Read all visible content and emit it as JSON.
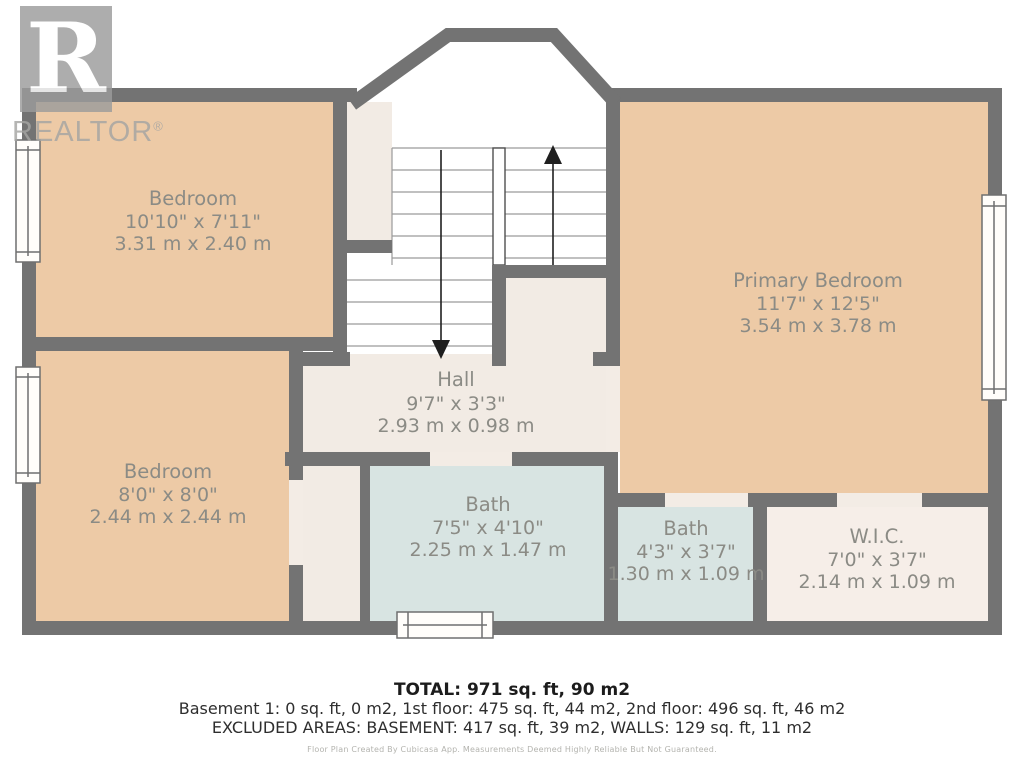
{
  "watermark": {
    "logo_letter": "R",
    "brand": "REALTOR",
    "registered": "®"
  },
  "colors": {
    "wall": "#737373",
    "room_peach": "#edcaa6",
    "room_cream": "#f2ebe4",
    "room_cream_light": "#f6eee8",
    "room_bath_blue": "#d8e4e2",
    "label_text": "#8b8b85",
    "window_fill": "#fffdfa",
    "arrow": "#1f1f1f"
  },
  "rooms": [
    {
      "id": "bedroom-top-left",
      "name": "Bedroom",
      "imperial": "10'10\" x 7'11\"",
      "metric": "3.31 m x 2.40 m"
    },
    {
      "id": "primary-bedroom",
      "name": "Primary Bedroom",
      "imperial": "11'7\" x 12'5\"",
      "metric": "3.54 m x 3.78 m"
    },
    {
      "id": "hall",
      "name": "Hall",
      "imperial": "9'7\" x 3'3\"",
      "metric": "2.93 m x 0.98 m"
    },
    {
      "id": "bedroom-bottom-left",
      "name": "Bedroom",
      "imperial": "8'0\" x 8'0\"",
      "metric": "2.44 m x 2.44 m"
    },
    {
      "id": "bath-main",
      "name": "Bath",
      "imperial": "7'5\" x 4'10\"",
      "metric": "2.25 m x 1.47 m"
    },
    {
      "id": "bath-small",
      "name": "Bath",
      "imperial": "4'3\" x 3'7\"",
      "metric": "1.30 m x 1.09 m"
    },
    {
      "id": "walk-in-closet",
      "name": "W.I.C.",
      "imperial": "7'0\" x 3'7\"",
      "metric": "2.14 m x 1.09 m"
    }
  ],
  "summary": {
    "total": "TOTAL: 971 sq. ft, 90 m2",
    "floors": "Basement 1: 0 sq. ft, 0 m2, 1st floor: 475 sq. ft, 44 m2, 2nd floor: 496 sq. ft, 46 m2",
    "excluded": "EXCLUDED AREAS: BASEMENT: 417 sq. ft, 39 m2, WALLS: 129 sq. ft, 11 m2",
    "disclaimer": "Floor Plan Created By Cubicasa App. Measurements Deemed Highly Reliable But Not Guaranteed."
  }
}
